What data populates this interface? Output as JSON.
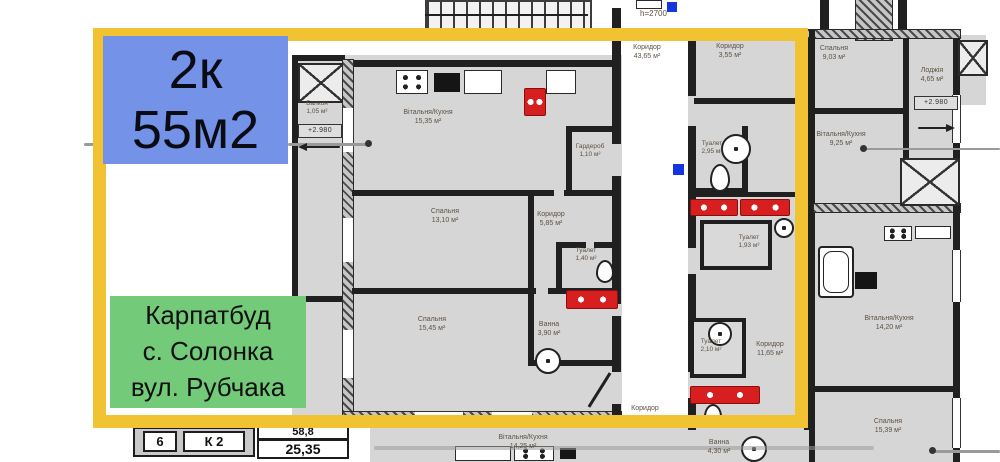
{
  "badges": {
    "size": {
      "line1": "2к",
      "line2": "55м2"
    },
    "developer": {
      "line1": "Карпатбуд",
      "line2": "с. Солонка",
      "line3": "вул. Рубчака"
    }
  },
  "plan": {
    "rooms": {
      "living_kitchen": {
        "name": "Вітальня/Кухня",
        "area": "15,35 м²"
      },
      "bedroom_13": {
        "name": "Спальня",
        "area": "13,10 м²"
      },
      "bedroom_15": {
        "name": "Спальня",
        "area": "15,45 м²"
      },
      "wardrobe": {
        "name": "Гардероб",
        "area": "1,10 м²"
      },
      "hall": {
        "name": "Коридор",
        "area": "5,85 м²"
      },
      "wc": {
        "name": "Туалет",
        "area": "1,40 м²"
      },
      "bath": {
        "name": "Ванна",
        "area": "3,90 м²"
      },
      "balcony": {
        "name": "Балкон",
        "area": "1,05 м²"
      },
      "common_corridor": {
        "name": "Коридор",
        "area": "43,65 м²"
      },
      "hall_355": {
        "name": "Коридор",
        "area": "3,55 м²"
      },
      "wc_295": {
        "name": "Туалет",
        "area": "2,95 м²"
      },
      "wc_193": {
        "name": "Туалет",
        "area": "1,93 м²"
      },
      "wc_210": {
        "name": "Туалет",
        "area": "2,10 м²"
      },
      "corridor_1165": {
        "name": "Коридор",
        "area": "11,65 м²"
      },
      "corridor_small": {
        "name": "Коридор",
        "area": ""
      },
      "living_1425": {
        "name": "Вітальня/Кухня",
        "area": "14,25 м²"
      },
      "bath_430": {
        "name": "Ванна",
        "area": "4,30 м²"
      },
      "bedroom_903": {
        "name": "Спальня",
        "area": "9,03 м²"
      },
      "loggia_465": {
        "name": "Лоджія",
        "area": "4,65 м²"
      },
      "living_925": {
        "name": "Вітальня/Кухня",
        "area": "9,25 м²"
      },
      "living_1420": {
        "name": "Вітальня/Кухня",
        "area": "14,20 м²"
      },
      "bedroom_1539": {
        "name": "Спальня",
        "area": "15,39 м²"
      }
    },
    "marks": {
      "level_left": "+2.980",
      "level_right": "+2.980",
      "ceiling": "h=2700"
    },
    "legend": {
      "apt_no": "6",
      "apt_type": "К 2",
      "total_area": "58,8",
      "living_area": "25,35"
    }
  },
  "colors": {
    "highlight": "#f1c232",
    "size_badge": "#7392e8",
    "developer_badge": "#73ca78",
    "plumbing": "#d81f1f"
  }
}
